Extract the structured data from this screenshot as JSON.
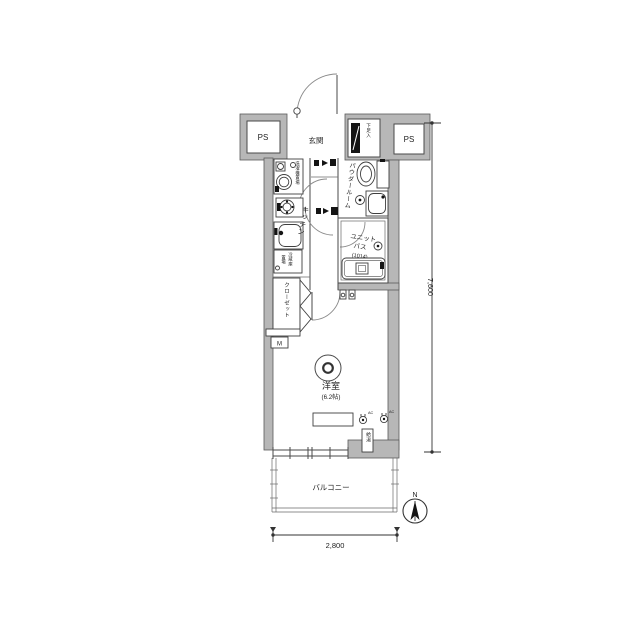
{
  "floorplan": {
    "labels": {
      "ps_left": "PS",
      "ps_right": "PS",
      "entrance": "玄関",
      "shoe_cupboard": "下足入",
      "powder_room": "パウダールーム",
      "unit_bath_line1": "ユニット",
      "unit_bath_line2": "バス",
      "unit_bath_module": "(1014)",
      "kitchen": "キッチン",
      "washer_space": "洗濯機置場",
      "fridge_space_line1": "冷蔵庫",
      "fridge_space_line2": "置場",
      "closet": "クローゼット",
      "main_room": "洋室",
      "main_room_size": "(6.2帖)",
      "water_heater": "給湯",
      "meter_box": "M",
      "balcony": "バルコニー",
      "ac_outlet": "AC"
    },
    "dimensions": {
      "vertical": "7,600",
      "horizontal": "2,800"
    },
    "compass": {
      "label": "N"
    },
    "colors": {
      "wall_fill": "#b7b7b7",
      "line": "#4a4a4a",
      "background": "#ffffff"
    }
  }
}
